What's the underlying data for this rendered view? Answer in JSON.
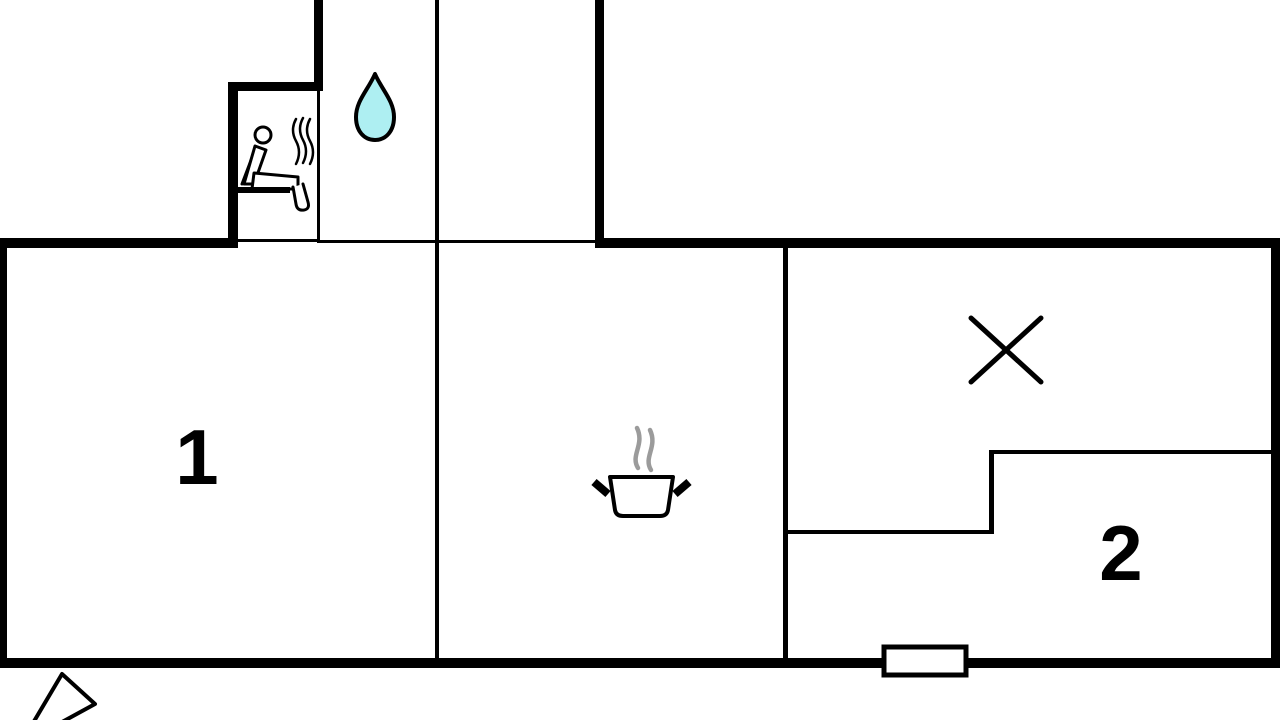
{
  "title": "floor-plan",
  "rooms": [
    {
      "label": "1"
    },
    {
      "label": "2"
    }
  ],
  "icons": {
    "sauna": "sauna-person-icon",
    "water_drop": "water-drop-icon",
    "cooking_pot": "cooking-pot-icon",
    "x_mark": "x-mark-icon",
    "window": "window-marker",
    "view_cone": "view-direction-cone"
  },
  "colors": {
    "wall": "#000000",
    "water_drop": "#aeeff2",
    "steam": "#9b9b9b",
    "background": "#ffffff"
  }
}
